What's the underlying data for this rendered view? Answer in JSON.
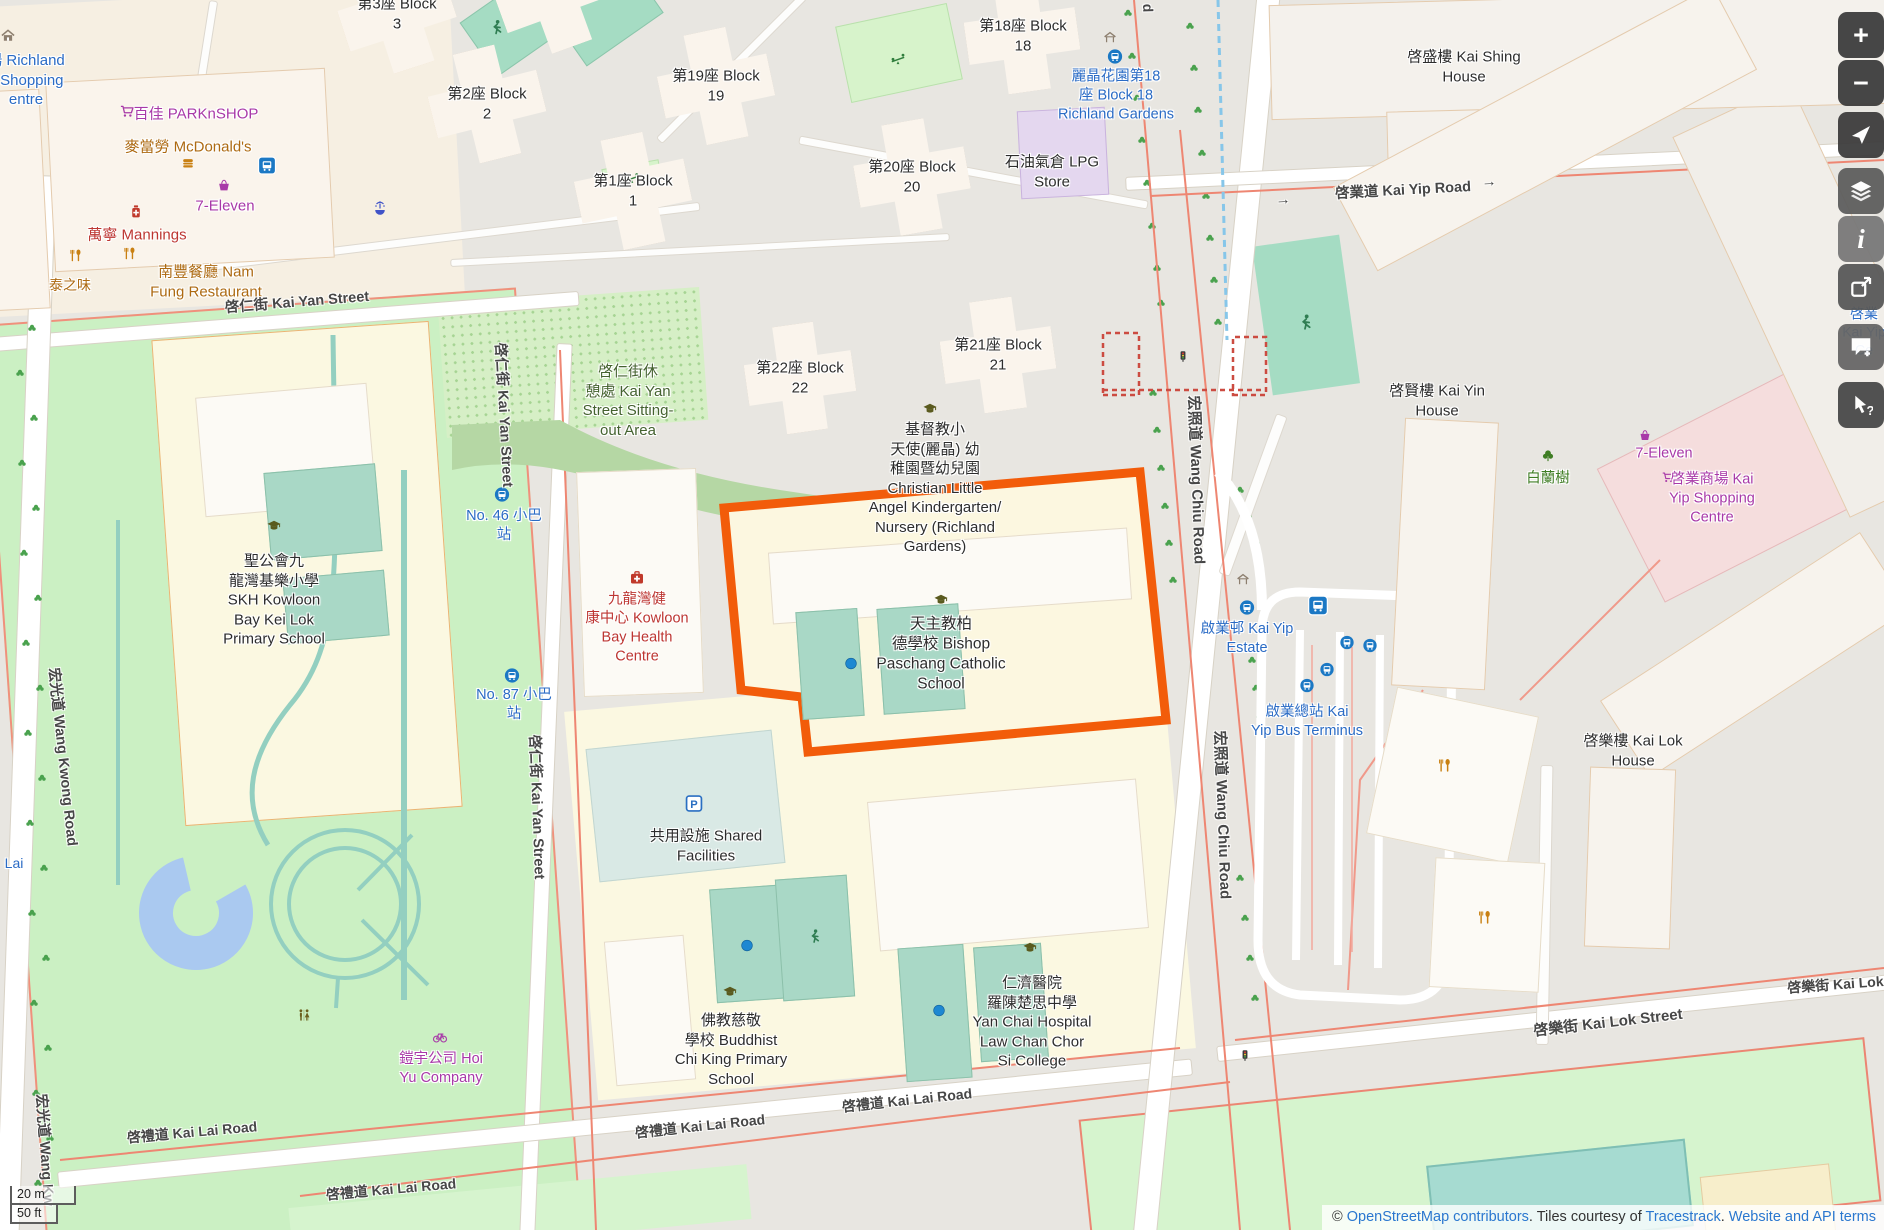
{
  "map": {
    "labels": [
      {
        "id": "richland-shopping-centre",
        "lines": [
          "場 Richland",
          "s Shopping",
          "entre"
        ],
        "x": 26,
        "y": 80,
        "c": "blue",
        "fs": 15
      },
      {
        "id": "parknshop",
        "lines": [
          "百佳 PARKnSHOP"
        ],
        "x": 196,
        "y": 114,
        "c": "purple",
        "fs": 15
      },
      {
        "id": "mcdonalds",
        "lines": [
          "麥當勞 McDonald's"
        ],
        "x": 188,
        "y": 147,
        "c": "amber",
        "fs": 15
      },
      {
        "id": "seven-eleven-west",
        "lines": [
          "7-Eleven"
        ],
        "x": 225,
        "y": 206,
        "c": "purple",
        "fs": 15
      },
      {
        "id": "mannings",
        "lines": [
          "萬寧 Mannings"
        ],
        "x": 137,
        "y": 235,
        "c": "red",
        "fs": 15
      },
      {
        "id": "nam-fung-restaurant",
        "lines": [
          "南豐餐廳 Nam",
          "Fung Restaurant"
        ],
        "x": 206,
        "y": 282,
        "c": "amber",
        "fs": 15
      },
      {
        "id": "thai-flavour",
        "lines": [
          "泰之味"
        ],
        "x": 70,
        "y": 285,
        "c": "amber",
        "fs": 14
      },
      {
        "id": "block-3",
        "lines": [
          "第3座 Block",
          "3"
        ],
        "x": 397,
        "y": 14,
        "c": "blk",
        "fs": 15
      },
      {
        "id": "block-2",
        "lines": [
          "第2座 Block",
          "2"
        ],
        "x": 487,
        "y": 104,
        "c": "blk",
        "fs": 15
      },
      {
        "id": "block-19",
        "lines": [
          "第19座 Block",
          "19"
        ],
        "x": 716,
        "y": 86,
        "c": "blk",
        "fs": 15
      },
      {
        "id": "block-1",
        "lines": [
          "第1座 Block",
          "1"
        ],
        "x": 633,
        "y": 191,
        "c": "blk",
        "fs": 15
      },
      {
        "id": "block-20",
        "lines": [
          "第20座 Block",
          "20"
        ],
        "x": 912,
        "y": 177,
        "c": "blk",
        "fs": 15
      },
      {
        "id": "block-18",
        "lines": [
          "第18座 Block",
          "18"
        ],
        "x": 1023,
        "y": 36,
        "c": "blk",
        "fs": 15
      },
      {
        "id": "block-22",
        "lines": [
          "第22座 Block",
          "22"
        ],
        "x": 800,
        "y": 378,
        "c": "blk",
        "fs": 15
      },
      {
        "id": "block-21",
        "lines": [
          "第21座 Block",
          "21"
        ],
        "x": 998,
        "y": 355,
        "c": "blk",
        "fs": 15
      },
      {
        "id": "kai-shing-house",
        "lines": [
          "啓盛樓 Kai Shing",
          "House"
        ],
        "x": 1464,
        "y": 67,
        "c": "blk",
        "fs": 15
      },
      {
        "id": "kai-yip-road",
        "lines": [
          "啓業道 Kai Yip Road"
        ],
        "x": 1403,
        "y": 191,
        "c": "gray",
        "fs": 14.5,
        "rot": -3
      },
      {
        "id": "arrow-kai-yip-w",
        "lines": [
          "→"
        ],
        "x": 1283,
        "y": 200,
        "c": "gray",
        "fs": 15,
        "rot": -3
      },
      {
        "id": "arrow-kai-yip-e",
        "lines": [
          "→"
        ],
        "x": 1489,
        "y": 182,
        "c": "gray",
        "fs": 15,
        "rot": -3
      },
      {
        "id": "richland-gardens-stop",
        "lines": [
          "麗晶花園第18",
          "座 Block 18",
          "Richland Gardens"
        ],
        "x": 1116,
        "y": 96,
        "c": "blue",
        "fs": 14.5
      },
      {
        "id": "lpg-store",
        "lines": [
          "石油氣倉 LPG",
          "Store"
        ],
        "x": 1052,
        "y": 172,
        "c": "blk",
        "fs": 15
      },
      {
        "id": "kai-yan-street-h",
        "lines": [
          "啓仁街 Kai Yan Street"
        ],
        "x": 297,
        "y": 303,
        "c": "gray",
        "fs": 14.5,
        "rot": -4.5
      },
      {
        "id": "sitting-out-area",
        "lines": [
          "啓仁街休",
          "憩處 Kai Yan",
          "Street Sitting-",
          "out Area"
        ],
        "x": 628,
        "y": 401,
        "c": "olive",
        "fs": 15
      },
      {
        "id": "kai-yan-street-v1",
        "lines": [
          "啓仁街 Kai Yan Street"
        ],
        "x": 503,
        "y": 415,
        "c": "gray",
        "fs": 14.5,
        "rot": 87
      },
      {
        "id": "kai-yan-street-v2",
        "lines": [
          "啓仁街 Kai Yan Street"
        ],
        "x": 536,
        "y": 807,
        "c": "gray",
        "fs": 14.5,
        "rot": 88
      },
      {
        "id": "minibus-46",
        "lines": [
          "No. 46 小巴",
          "站"
        ],
        "x": 504,
        "y": 526,
        "c": "blue",
        "fs": 14.5
      },
      {
        "id": "minibus-87",
        "lines": [
          "No. 87 小巴",
          "站"
        ],
        "x": 514,
        "y": 705,
        "c": "blue",
        "fs": 14.5
      },
      {
        "id": "skh-kei-lok-school",
        "lines": [
          "聖公會九",
          "龍灣基樂小學",
          "SKH Kowloon",
          "Bay Kei Lok",
          "Primary School"
        ],
        "x": 274,
        "y": 600,
        "c": "blk",
        "fs": 15
      },
      {
        "id": "kowloon-bay-health-centre",
        "lines": [
          "九龍灣健",
          "康中心 Kowloon",
          "Bay Health",
          "Centre"
        ],
        "x": 637,
        "y": 628,
        "c": "red",
        "fs": 14.5
      },
      {
        "id": "christian-little-angel",
        "lines": [
          "基督教小",
          "天使(麗晶) 幼",
          "稚園暨幼兒園",
          "Christian Little",
          "Angel Kindergarten/",
          "Nursery (Richland",
          "Gardens)"
        ],
        "x": 935,
        "y": 488,
        "c": "blk",
        "fs": 15
      },
      {
        "id": "bishop-paschang-school",
        "lines": [
          "天主教柏",
          "德學校 Bishop",
          "Paschang Catholic",
          "School"
        ],
        "x": 941,
        "y": 655,
        "c": "blk",
        "fs": 15.5
      },
      {
        "id": "wang-chiu-road-v1",
        "lines": [
          "宏照道 Wang Chiu Road"
        ],
        "x": 1196,
        "y": 480,
        "c": "gray",
        "fs": 15,
        "rot": 88
      },
      {
        "id": "wang-chiu-road-v2",
        "lines": [
          "宏照道 Wang Chiu Road"
        ],
        "x": 1222,
        "y": 815,
        "c": "gray",
        "fs": 15,
        "rot": 88
      },
      {
        "id": "wang-chiu-road-tail",
        "lines": [
          "d"
        ],
        "x": 1148,
        "y": 8,
        "c": "gray",
        "fs": 14,
        "rot": 88
      },
      {
        "id": "kai-yin-house",
        "lines": [
          "啓賢樓 Kai Yin",
          "House"
        ],
        "x": 1437,
        "y": 401,
        "c": "blk",
        "fs": 15
      },
      {
        "id": "pak-lan-tree",
        "lines": [
          "白蘭樹"
        ],
        "x": 1548,
        "y": 479,
        "c": "green",
        "fs": 14.5
      },
      {
        "id": "seven-eleven-east",
        "lines": [
          "7-Eleven"
        ],
        "x": 1664,
        "y": 454,
        "c": "purple",
        "fs": 14.5
      },
      {
        "id": "kai-yip-shopping-centre",
        "lines": [
          "啓業商場 Kai",
          "Yip Shopping",
          "Centre"
        ],
        "x": 1712,
        "y": 499,
        "c": "purple",
        "fs": 14.5
      },
      {
        "id": "kai-yip-estate",
        "lines": [
          "啟業邨 Kai Yip",
          "Estate"
        ],
        "x": 1247,
        "y": 639,
        "c": "blue",
        "fs": 14.5
      },
      {
        "id": "kai-yip-bus-terminus",
        "lines": [
          "啟業總站 Kai",
          "Yip Bus Terminus"
        ],
        "x": 1307,
        "y": 722,
        "c": "blue",
        "fs": 14.5
      },
      {
        "id": "kai-lok-house",
        "lines": [
          "啓樂樓 Kai Lok",
          "House"
        ],
        "x": 1633,
        "y": 751,
        "c": "blk",
        "fs": 15
      },
      {
        "id": "shared-facilities",
        "lines": [
          "共用設施 Shared",
          "Facilities"
        ],
        "x": 706,
        "y": 846,
        "c": "blk",
        "fs": 15
      },
      {
        "id": "buddhist-chi-king-school",
        "lines": [
          "佛教慈敬",
          "學校 Buddhist",
          "Chi King Primary",
          "School"
        ],
        "x": 731,
        "y": 1050,
        "c": "blk",
        "fs": 15
      },
      {
        "id": "yan-chai-college",
        "lines": [
          "仁濟醫院",
          "羅陳楚思中學",
          "Yan Chai Hospital",
          "Law Chan Chor",
          "Si College"
        ],
        "x": 1032,
        "y": 1022,
        "c": "blk",
        "fs": 15
      },
      {
        "id": "hoi-yu-company",
        "lines": [
          "鎧宇公司 Hoi",
          "Yu Company"
        ],
        "x": 441,
        "y": 1069,
        "c": "purple",
        "fs": 14.5
      },
      {
        "id": "kai-lai-road-1",
        "lines": [
          "啓禮道 Kai Lai Road"
        ],
        "x": 192,
        "y": 1132,
        "c": "gray",
        "fs": 14,
        "rot": -5
      },
      {
        "id": "kai-lai-road-2",
        "lines": [
          "啓禮道 Kai Lai Road"
        ],
        "x": 391,
        "y": 1189,
        "c": "gray",
        "fs": 14,
        "rot": -5
      },
      {
        "id": "kai-lai-road-3",
        "lines": [
          "啓禮道 Kai Lai Road"
        ],
        "x": 700,
        "y": 1126,
        "c": "gray",
        "fs": 14,
        "rot": -6
      },
      {
        "id": "kai-lai-road-4",
        "lines": [
          "啓禮道 Kai Lai Road"
        ],
        "x": 907,
        "y": 1100,
        "c": "gray",
        "fs": 14,
        "rot": -6
      },
      {
        "id": "kai-lok-street-1",
        "lines": [
          "啓樂街 Kai Lok Street"
        ],
        "x": 1608,
        "y": 1023,
        "c": "gray",
        "fs": 15,
        "rot": -6.5
      },
      {
        "id": "kai-lok-street-2",
        "lines": [
          "啓樂街 Kai Lok S"
        ],
        "x": 1842,
        "y": 984,
        "c": "gray",
        "fs": 14,
        "rot": -4
      },
      {
        "id": "wang-kwong-road-v1",
        "lines": [
          "宏光道 Wang Kwong Road"
        ],
        "x": 62,
        "y": 757,
        "c": "gray",
        "fs": 14.5,
        "rot": 84
      },
      {
        "id": "wang-kwong-road-v2",
        "lines": [
          "宏光道 Wang Kw"
        ],
        "x": 44,
        "y": 1150,
        "c": "gray",
        "fs": 14.5,
        "rot": 86
      },
      {
        "id": "lai-partial",
        "lines": [
          "Lai"
        ],
        "x": 14,
        "y": 863,
        "c": "blue",
        "fs": 14
      },
      {
        "id": "kai-yip-edge-partial",
        "lines": [
          "啓業",
          "Kai Yip",
          "Ce"
        ],
        "x": 1864,
        "y": 332,
        "c": "blue",
        "fs": 14
      }
    ],
    "icons": [
      {
        "t": "home",
        "x": 8,
        "y": 38,
        "s": 15
      },
      {
        "t": "busstation",
        "x": 267,
        "y": 168,
        "s": 18
      },
      {
        "t": "fountain",
        "x": 380,
        "y": 210,
        "s": 16
      },
      {
        "t": "cart",
        "x": 127,
        "y": 114,
        "s": 15
      },
      {
        "t": "burger",
        "x": 188,
        "y": 166,
        "s": 14
      },
      {
        "t": "basket",
        "x": 224,
        "y": 188,
        "s": 14
      },
      {
        "t": "pharm",
        "x": 136,
        "y": 214,
        "s": 15
      },
      {
        "t": "fork",
        "x": 76,
        "y": 258,
        "s": 14
      },
      {
        "t": "fork",
        "x": 130,
        "y": 256,
        "s": 14
      },
      {
        "t": "player",
        "x": 497,
        "y": 30,
        "s": 17
      },
      {
        "t": "seesaw",
        "x": 632,
        "y": 181,
        "s": 15
      },
      {
        "t": "seesaw",
        "x": 898,
        "y": 62,
        "s": 16
      },
      {
        "t": "shelter",
        "x": 1110,
        "y": 40,
        "s": 14
      },
      {
        "t": "busstop",
        "x": 1115,
        "y": 59,
        "s": 15
      },
      {
        "t": "school",
        "x": 274,
        "y": 529,
        "s": 16
      },
      {
        "t": "school",
        "x": 930,
        "y": 412,
        "s": 16
      },
      {
        "t": "school",
        "x": 941,
        "y": 603,
        "s": 16
      },
      {
        "t": "school",
        "x": 730,
        "y": 995,
        "s": 16
      },
      {
        "t": "school",
        "x": 1030,
        "y": 951,
        "s": 16
      },
      {
        "t": "hosp",
        "x": 637,
        "y": 580,
        "s": 16
      },
      {
        "t": "busstop",
        "x": 502,
        "y": 497,
        "s": 15
      },
      {
        "t": "busstop",
        "x": 512,
        "y": 678,
        "s": 15
      },
      {
        "t": "dot",
        "x": 851,
        "y": 666,
        "s": 13
      },
      {
        "t": "dot",
        "x": 747,
        "y": 948,
        "s": 13
      },
      {
        "t": "dot",
        "x": 939,
        "y": 1013,
        "s": 13
      },
      {
        "t": "player",
        "x": 815,
        "y": 939,
        "s": 16
      },
      {
        "t": "player",
        "x": 1306,
        "y": 325,
        "s": 18
      },
      {
        "t": "parking",
        "x": 694,
        "y": 806,
        "s": 17
      },
      {
        "t": "wc",
        "x": 304,
        "y": 1018,
        "s": 15
      },
      {
        "t": "bicycle",
        "x": 440,
        "y": 1039,
        "s": 16
      },
      {
        "t": "tl",
        "x": 1183,
        "y": 359,
        "s": 13
      },
      {
        "t": "tl",
        "x": 1245,
        "y": 1058,
        "s": 13
      },
      {
        "t": "shelter",
        "x": 1243,
        "y": 582,
        "s": 14
      },
      {
        "t": "busstop",
        "x": 1247,
        "y": 610,
        "s": 15
      },
      {
        "t": "busstation",
        "x": 1318,
        "y": 608,
        "s": 20
      },
      {
        "t": "busstop",
        "x": 1347,
        "y": 645,
        "s": 14
      },
      {
        "t": "busstop",
        "x": 1370,
        "y": 648,
        "s": 14
      },
      {
        "t": "busstop",
        "x": 1327,
        "y": 672,
        "s": 14
      },
      {
        "t": "busstop",
        "x": 1307,
        "y": 688,
        "s": 14
      },
      {
        "t": "bigtree",
        "x": 1548,
        "y": 458,
        "s": 15
      },
      {
        "t": "fork",
        "x": 1445,
        "y": 768,
        "s": 15
      },
      {
        "t": "fork",
        "x": 1485,
        "y": 920,
        "s": 15
      },
      {
        "t": "basket",
        "x": 1645,
        "y": 438,
        "s": 13
      },
      {
        "t": "cart",
        "x": 1668,
        "y": 480,
        "s": 13
      }
    ],
    "icon_colors": {
      "busstop": "#1b78c4",
      "busstation": "#1b78c4",
      "school": "#5a5a1e",
      "fork": "#c98012",
      "burger": "#c98012",
      "cart": "#a839a8",
      "basket": "#a839a8",
      "bicycle": "#a839a8",
      "pharm": "#c0392b",
      "hosp": "#c0392b",
      "wc": "#6b5f1e",
      "fountain": "#4053c8",
      "seesaw": "#2f7d3c",
      "player": "#2f7d52",
      "parking": "#2a6fc2",
      "tree": "#4aa24e",
      "bigtree": "#3f7d24",
      "shelter": "#8d7f6f",
      "home": "#8d7f6f",
      "tl": "#3a3a3a",
      "dot": "#1e88d2"
    },
    "trees": [
      [
        18,
        195
      ],
      [
        30,
        240
      ],
      [
        18,
        285
      ],
      [
        32,
        330
      ],
      [
        20,
        375
      ],
      [
        34,
        420
      ],
      [
        22,
        465
      ],
      [
        36,
        510
      ],
      [
        24,
        555
      ],
      [
        38,
        600
      ],
      [
        26,
        645
      ],
      [
        40,
        690
      ],
      [
        28,
        735
      ],
      [
        42,
        780
      ],
      [
        30,
        825
      ],
      [
        44,
        870
      ],
      [
        32,
        915
      ],
      [
        46,
        960
      ],
      [
        34,
        1005
      ],
      [
        48,
        1050
      ],
      [
        36,
        1095
      ],
      [
        50,
        1140
      ],
      [
        38,
        1185
      ],
      [
        1128,
        15
      ],
      [
        1132,
        58
      ],
      [
        1137,
        100
      ],
      [
        1142,
        142
      ],
      [
        1147,
        185
      ],
      [
        1152,
        228
      ],
      [
        1157,
        270
      ],
      [
        1161,
        305
      ],
      [
        1190,
        28
      ],
      [
        1194,
        70
      ],
      [
        1198,
        112
      ],
      [
        1202,
        155
      ],
      [
        1206,
        198
      ],
      [
        1210,
        240
      ],
      [
        1214,
        282
      ],
      [
        1218,
        324
      ],
      [
        1153,
        395
      ],
      [
        1157,
        432
      ],
      [
        1161,
        470
      ],
      [
        1165,
        508
      ],
      [
        1169,
        545
      ],
      [
        1173,
        582
      ],
      [
        1240,
        492
      ],
      [
        1248,
        518
      ],
      [
        1256,
        544
      ],
      [
        1252,
        662
      ],
      [
        1256,
        690
      ],
      [
        1260,
        718
      ],
      [
        1240,
        880
      ],
      [
        1245,
        920
      ],
      [
        1250,
        960
      ],
      [
        1255,
        1000
      ]
    ],
    "controls": [
      {
        "id": "zoom-in",
        "g": "+",
        "top": 12,
        "bg": "#3c3c3c"
      },
      {
        "id": "zoom-out",
        "g": "−",
        "top": 60,
        "bg": "#3c3c3c"
      },
      {
        "id": "locate",
        "s": "nav",
        "top": 112,
        "bg": "#3c3c3c"
      },
      {
        "id": "layers",
        "s": "layers",
        "top": 168,
        "bg": "#5d5d5d"
      },
      {
        "id": "info",
        "g": "i",
        "top": 216,
        "bg": "#787878"
      },
      {
        "id": "share",
        "s": "share",
        "top": 264,
        "bg": "#585858"
      },
      {
        "id": "add-note",
        "s": "note",
        "top": 324,
        "bg": "#666666"
      },
      {
        "id": "query-features",
        "s": "query",
        "top": 382,
        "bg": "#484848"
      }
    ],
    "highlight_color": "#f25c0a"
  },
  "scalebar": {
    "metric": "20 m",
    "imperial": "50 ft"
  },
  "attribution": {
    "copyright": "© ",
    "link_osm": "OpenStreetMap contributors",
    "mid1": ". Tiles courtesy of ",
    "link_tiles": "Tracestrack",
    "mid2": ". ",
    "link_terms": "Website and API terms"
  }
}
